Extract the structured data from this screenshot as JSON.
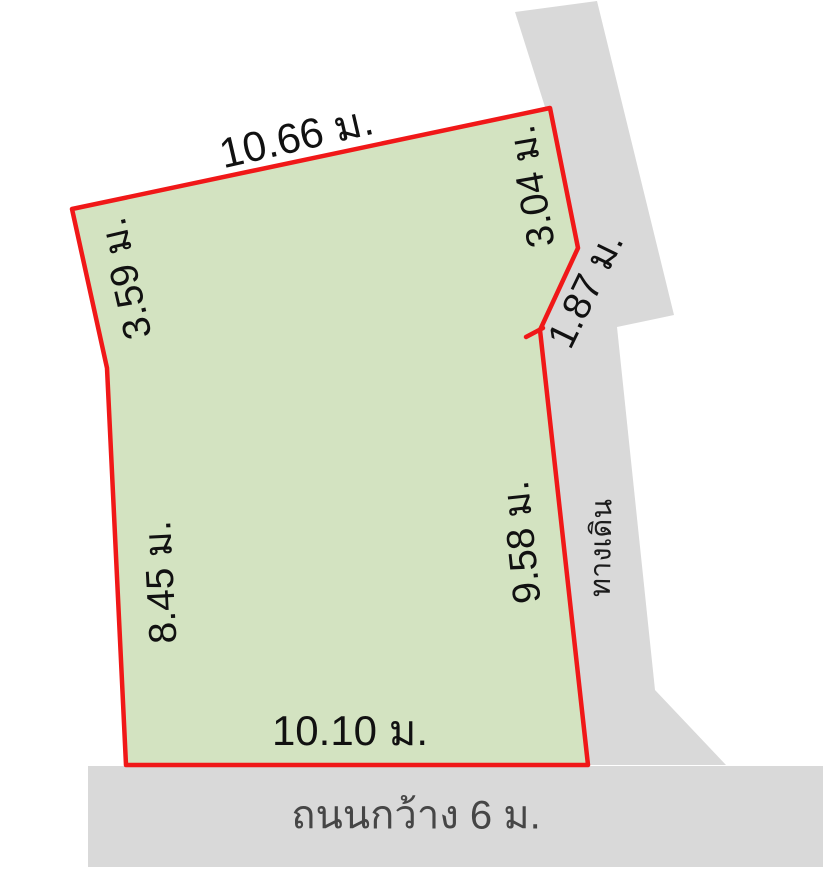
{
  "diagram": {
    "description": "Land plot survey sketch with edge dimensions in meters",
    "labels": {
      "top": "10.66 ม.",
      "upper_left": "3.59 ม.",
      "lower_left": "8.45 ม.",
      "bottom": "10.10 ม.",
      "right": "9.58 ม.",
      "upper_right": "3.04 ม.",
      "notch": "1.87 ม.",
      "road": "ถนนกว้าง 6 ม.",
      "walkway": "ทางเดิน"
    },
    "edges": [
      {
        "side": "top",
        "length_m": 10.66
      },
      {
        "side": "upper-left",
        "length_m": 3.59
      },
      {
        "side": "lower-left",
        "length_m": 8.45
      },
      {
        "side": "bottom",
        "length_m": 10.1
      },
      {
        "side": "right",
        "length_m": 9.58
      },
      {
        "side": "upper-right",
        "length_m": 3.04
      },
      {
        "side": "notch",
        "length_m": 1.87
      }
    ],
    "road_width_m": 6,
    "colors": {
      "plot_fill": "#d3e3c1",
      "plot_outline": "#f01818",
      "paving": "#d9d9d9",
      "dimension_text": "#111111",
      "road_text": "#464646",
      "walkway_text": "#1c1c1c",
      "background": "#ffffff"
    }
  }
}
